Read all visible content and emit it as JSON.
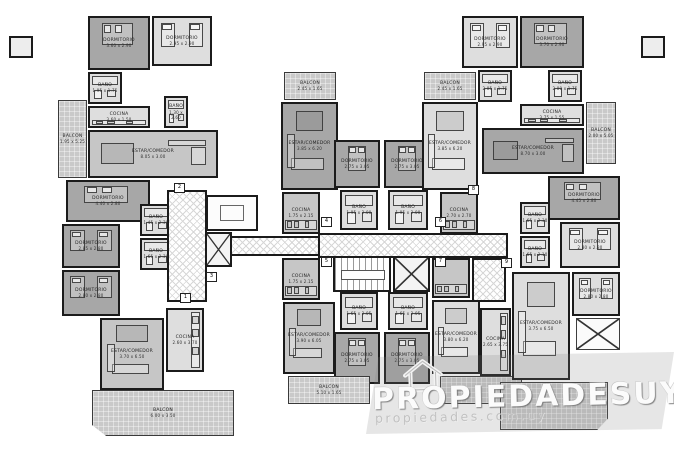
{
  "watermark": {
    "brand": "PROPIEDADESUY",
    "site": "propiedades.com.uy",
    "icon": "house-icon"
  },
  "palette": {
    "wall": "#1b1b1b",
    "room_dark": "#a7a7a7",
    "room_medium": "#c6c6c6",
    "room_light": "#dedede",
    "balcony": "#c9c9c9",
    "background": "#ffffff"
  },
  "rooms": [
    {
      "label": "DORMITORIO",
      "dims": "3.60 x 2.90",
      "x": 88,
      "y": 16,
      "w": 62,
      "h": 54,
      "type": "dark",
      "furn": "bed-h"
    },
    {
      "label": "DORMITORIO",
      "dims": "2.95 x 2.90",
      "x": 152,
      "y": 16,
      "w": 60,
      "h": 50,
      "type": "light",
      "furn": "twin"
    },
    {
      "label": "BAÑO",
      "dims": "1.95 x 1.75",
      "x": 88,
      "y": 72,
      "w": 34,
      "h": 32,
      "type": "light",
      "furn": "bath"
    },
    {
      "label": "COCINA",
      "dims": "3.60 x 1.50",
      "x": 88,
      "y": 106,
      "w": 62,
      "h": 22,
      "type": "light",
      "furn": "kitchen-b"
    },
    {
      "label": "BAÑO",
      "dims": "1.30 x 2.60",
      "x": 164,
      "y": 96,
      "w": 24,
      "h": 32,
      "type": "light",
      "furn": "bath"
    },
    {
      "label": "ESTAR/COMEDOR",
      "dims": "8.05 x 3.00",
      "x": 88,
      "y": 130,
      "w": 130,
      "h": 48,
      "type": "medium",
      "furn": "living-h"
    },
    {
      "label": "BALCON",
      "dims": "1.95 x 5.25",
      "x": 58,
      "y": 100,
      "w": 29,
      "h": 78,
      "type": "balcony"
    },
    {
      "label": "DORMITORIO",
      "dims": "4.40 x 2.80",
      "x": 66,
      "y": 180,
      "w": 84,
      "h": 42,
      "type": "dark",
      "furn": "bed-h"
    },
    {
      "label": "BAÑO",
      "dims": "1.45 x 2.30",
      "x": 140,
      "y": 204,
      "w": 32,
      "h": 32,
      "type": "light",
      "furn": "bath"
    },
    {
      "label": "BAÑO",
      "dims": "1.65 x 2.30",
      "x": 140,
      "y": 238,
      "w": 32,
      "h": 32,
      "type": "light",
      "furn": "bath"
    },
    {
      "label": "DORMITORIO",
      "dims": "2.85 x 2.80",
      "x": 62,
      "y": 224,
      "w": 58,
      "h": 44,
      "type": "dark",
      "furn": "twin"
    },
    {
      "label": "DORMITORIO",
      "dims": "2.80 x 2.80",
      "x": 62,
      "y": 270,
      "w": 58,
      "h": 46,
      "type": "dark",
      "furn": "twin"
    },
    {
      "label": "ESTAR/COMEDOR",
      "dims": "3.70 x 6.50",
      "x": 100,
      "y": 318,
      "w": 64,
      "h": 72,
      "type": "medium",
      "furn": "living-v"
    },
    {
      "label": "COCINA",
      "dims": "2.60 x 3.70",
      "x": 166,
      "y": 308,
      "w": 38,
      "h": 64,
      "type": "light",
      "furn": "kitchen-r"
    },
    {
      "label": "BALCON",
      "dims": "6.00 x 3.50",
      "x": 92,
      "y": 390,
      "w": 142,
      "h": 46,
      "type": "balcony",
      "clip": "polygon(0 0,100% 0,100% 100%,10% 100%,0 76%)"
    },
    {
      "label": "",
      "dims": "",
      "x": 206,
      "y": 195,
      "w": 52,
      "h": 36,
      "type": "plain",
      "furn": "inset"
    },
    {
      "label": "BALCON",
      "dims": "2.45 x 1.65",
      "x": 284,
      "y": 72,
      "w": 52,
      "h": 28,
      "type": "balcony"
    },
    {
      "label": "ESTAR/COMEDOR",
      "dims": "3.85 x 6.20",
      "x": 281,
      "y": 102,
      "w": 57,
      "h": 88,
      "type": "dark",
      "furn": "living-v"
    },
    {
      "label": "COCINA",
      "dims": "1.75 x 2.15",
      "x": 282,
      "y": 192,
      "w": 38,
      "h": 42,
      "type": "medium",
      "furn": "kitchen-b"
    },
    {
      "label": "COCINA",
      "dims": "1.75 x 2.15",
      "x": 282,
      "y": 258,
      "w": 38,
      "h": 42,
      "type": "medium",
      "furn": "kitchen-b"
    },
    {
      "label": "DORMITORIO",
      "dims": "2.75 x 3.05",
      "x": 334,
      "y": 140,
      "w": 46,
      "h": 48,
      "type": "dark",
      "furn": "bed-v"
    },
    {
      "label": "DORMITORIO",
      "dims": "2.75 x 3.05",
      "x": 384,
      "y": 140,
      "w": 46,
      "h": 48,
      "type": "dark",
      "furn": "bed-v"
    },
    {
      "label": "BAÑO",
      "dims": "1.95 x 2.00",
      "x": 340,
      "y": 190,
      "w": 38,
      "h": 40,
      "type": "light",
      "furn": "bath"
    },
    {
      "label": "BAÑO",
      "dims": "1.95 x 2.00",
      "x": 388,
      "y": 190,
      "w": 40,
      "h": 40,
      "type": "light",
      "furn": "bath"
    },
    {
      "label": "BAÑO",
      "dims": "1.65 x 2.05",
      "x": 340,
      "y": 292,
      "w": 38,
      "h": 38,
      "type": "light",
      "furn": "bath"
    },
    {
      "label": "BAÑO",
      "dims": "1.65 x 2.05",
      "x": 388,
      "y": 292,
      "w": 40,
      "h": 38,
      "type": "light",
      "furn": "bath"
    },
    {
      "label": "DORMITORIO",
      "dims": "2.75 x 3.05",
      "x": 334,
      "y": 332,
      "w": 46,
      "h": 52,
      "type": "dark",
      "furn": "bed-v"
    },
    {
      "label": "DORMITORIO",
      "dims": "2.75 x 3.05",
      "x": 384,
      "y": 332,
      "w": 46,
      "h": 52,
      "type": "dark",
      "furn": "bed-v"
    },
    {
      "label": "ESTAR/COMEDOR",
      "dims": "3.90 x 6.05",
      "x": 283,
      "y": 302,
      "w": 52,
      "h": 72,
      "type": "medium",
      "furn": "living-v"
    },
    {
      "label": "BALCON",
      "dims": "5.10 x 1.65",
      "x": 288,
      "y": 376,
      "w": 82,
      "h": 28,
      "type": "balcony"
    },
    {
      "label": "BALCON",
      "dims": "2.45 x 1.65",
      "x": 424,
      "y": 72,
      "w": 52,
      "h": 28,
      "type": "balcony"
    },
    {
      "label": "ESTAR/COMEDOR",
      "dims": "3.85 x 6.20",
      "x": 422,
      "y": 102,
      "w": 56,
      "h": 88,
      "type": "light",
      "furn": "living-v"
    },
    {
      "label": "COCINA",
      "dims": "2.70 x 2.70",
      "x": 440,
      "y": 192,
      "w": 38,
      "h": 42,
      "type": "medium",
      "furn": "kitchen-b"
    },
    {
      "label": "",
      "dims": "",
      "x": 432,
      "y": 258,
      "w": 38,
      "h": 40,
      "type": "medium",
      "furn": "kitchen-b"
    },
    {
      "label": "ESTAR/COMEDOR",
      "dims": "3.80 x 6.20",
      "x": 432,
      "y": 300,
      "w": 48,
      "h": 74,
      "type": "light",
      "furn": "living-v"
    },
    {
      "label": "",
      "dims": "",
      "x": 440,
      "y": 376,
      "w": 82,
      "h": 28,
      "type": "balcony"
    },
    {
      "label": "DORMITORIO",
      "dims": "2.95 x 2.90",
      "x": 462,
      "y": 16,
      "w": 56,
      "h": 52,
      "type": "light",
      "furn": "twin"
    },
    {
      "label": "DORMITORIO",
      "dims": "3.70 x 2.90",
      "x": 520,
      "y": 16,
      "w": 64,
      "h": 52,
      "type": "dark",
      "furn": "bed-h"
    },
    {
      "label": "BAÑO",
      "dims": "2.05 x 1.75",
      "x": 478,
      "y": 70,
      "w": 34,
      "h": 32,
      "type": "light",
      "furn": "bath"
    },
    {
      "label": "BAÑO",
      "dims": "2.00 x 1.75",
      "x": 548,
      "y": 70,
      "w": 34,
      "h": 32,
      "type": "light",
      "furn": "bath"
    },
    {
      "label": "COCINA",
      "dims": "3.75 x 1.55",
      "x": 520,
      "y": 104,
      "w": 64,
      "h": 22,
      "type": "light",
      "furn": "kitchen-b"
    },
    {
      "label": "ESTAR/COMEDOR",
      "dims": "8.70 x 3.00",
      "x": 482,
      "y": 128,
      "w": 102,
      "h": 46,
      "type": "dark",
      "furn": "living-h"
    },
    {
      "label": "BALCON",
      "dims": "2.00 x 5.05",
      "x": 586,
      "y": 102,
      "w": 30,
      "h": 62,
      "type": "balcony"
    },
    {
      "label": "DORMITORIO",
      "dims": "4.45 x 2.80",
      "x": 548,
      "y": 176,
      "w": 72,
      "h": 44,
      "type": "dark",
      "furn": "bed-h"
    },
    {
      "label": "BAÑO",
      "dims": "1.65 x 2.30",
      "x": 520,
      "y": 202,
      "w": 30,
      "h": 32,
      "type": "light",
      "furn": "bath"
    },
    {
      "label": "BAÑO",
      "dims": "1.65 x 2.10",
      "x": 520,
      "y": 236,
      "w": 30,
      "h": 32,
      "type": "light",
      "furn": "bath"
    },
    {
      "label": "DORMITORIO",
      "dims": "2.80 x 2.80",
      "x": 560,
      "y": 222,
      "w": 60,
      "h": 46,
      "type": "light",
      "furn": "twin"
    },
    {
      "label": "DORMITORIO",
      "dims": "2.80 x 2.80",
      "x": 572,
      "y": 272,
      "w": 48,
      "h": 44,
      "type": "light",
      "furn": "twin"
    },
    {
      "label": "ESTAR/COMEDOR",
      "dims": "3.75 x 6.50",
      "x": 512,
      "y": 272,
      "w": 58,
      "h": 108,
      "type": "light",
      "furn": "living-v"
    },
    {
      "label": "COCINA",
      "dims": "2.65 x 3.75",
      "x": 480,
      "y": 308,
      "w": 31,
      "h": 68,
      "type": "light",
      "furn": "kitchen-r"
    },
    {
      "label": "",
      "dims": "",
      "x": 500,
      "y": 382,
      "w": 108,
      "h": 48,
      "type": "balcony",
      "clip": "polygon(0 0,100% 0,100% 76%,90% 100%,0 100%)"
    }
  ],
  "core": {
    "corridors": [
      {
        "x": 167,
        "y": 190,
        "w": 40,
        "h": 112
      },
      {
        "x": 230,
        "y": 236,
        "w": 92,
        "h": 20
      },
      {
        "x": 318,
        "y": 233,
        "w": 190,
        "h": 25
      },
      {
        "x": 472,
        "y": 258,
        "w": 34,
        "h": 44
      }
    ],
    "elevators": [
      {
        "x": 205,
        "y": 232,
        "w": 27,
        "h": 35
      },
      {
        "x": 393,
        "y": 256,
        "w": 37,
        "h": 36
      }
    ],
    "crossboxes": [
      {
        "x": 576,
        "y": 318,
        "w": 44,
        "h": 32
      }
    ],
    "stair": {
      "x": 333,
      "y": 256,
      "w": 58,
      "h": 36
    }
  },
  "unit_badges": [
    {
      "n": "1",
      "x": 180,
      "y": 293
    },
    {
      "n": "2",
      "x": 174,
      "y": 183
    },
    {
      "n": "3",
      "x": 206,
      "y": 272
    },
    {
      "n": "4",
      "x": 321,
      "y": 217
    },
    {
      "n": "5",
      "x": 321,
      "y": 257
    },
    {
      "n": "6",
      "x": 435,
      "y": 217
    },
    {
      "n": "7",
      "x": 435,
      "y": 257
    },
    {
      "n": "8",
      "x": 468,
      "y": 185
    },
    {
      "n": "9",
      "x": 501,
      "y": 258
    }
  ],
  "wall_stubs": [
    {
      "x": 9,
      "y": 36,
      "w": 24,
      "h": 22
    },
    {
      "x": 641,
      "y": 36,
      "w": 24,
      "h": 22
    }
  ]
}
